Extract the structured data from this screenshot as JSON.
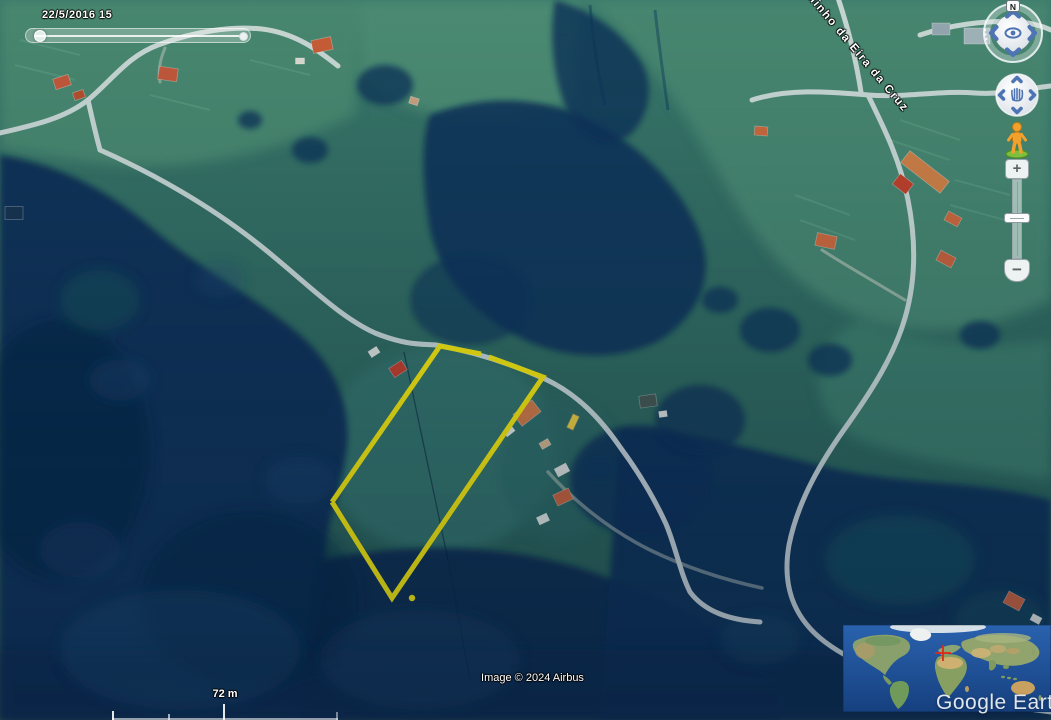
{
  "timeline": {
    "date_label": "22/5/2016  15"
  },
  "navigation": {
    "north_label": "N",
    "zoom_in_label": "+",
    "zoom_out_label": "−"
  },
  "labels": {
    "road_name": "Caminho da Eira da Cruz",
    "scale": "72 m",
    "copyright": "Image © 2024 Airbus",
    "logo": "Google Earth"
  },
  "parcel": {
    "color": "#f2e40a",
    "stroke_width": 5,
    "outline_segments": [
      [
        [
          332,
          502
        ],
        [
          440,
          346
        ],
        [
          481,
          354
        ]
      ],
      [
        [
          489,
          357
        ],
        [
          543,
          377
        ],
        [
          392,
          598
        ],
        [
          332,
          502
        ]
      ]
    ],
    "dot": {
      "x": 412,
      "y": 598,
      "r": 3.2
    }
  },
  "overview_map": {
    "marker_color": "#e02818",
    "marker": {
      "x": 100,
      "y": 28,
      "arm": 8
    }
  }
}
